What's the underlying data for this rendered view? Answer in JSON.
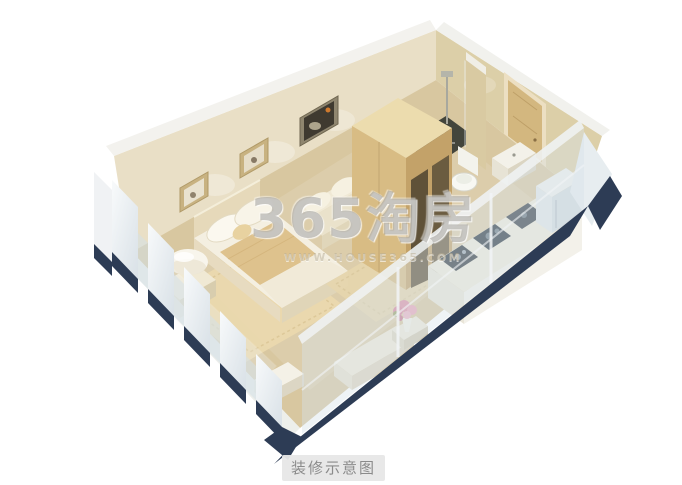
{
  "watermark": {
    "brand": "365淘房",
    "site": "WWW.HOUSE365.COM"
  },
  "caption": {
    "label": "装修示意图"
  },
  "palette": {
    "background": "#ffffff",
    "floor": "#d8c7a0",
    "wall_left": "#e9dfc6",
    "wall_right": "#dccfa8",
    "wall_cap": "#f3f2ee",
    "exterior_white": "#eef1f3",
    "base_navy": "#2d3c55",
    "glass": "#d7e2e9",
    "wardrobe_front": "#d8bc84",
    "wardrobe_side": "#c3a269",
    "wardrobe_top": "#ecdcae",
    "bed_blanket": "#dec28d",
    "rug": "#ead9ae",
    "counter_top": "#eeeadb",
    "appliance_dark": "#333c42",
    "tile_dark": "#43453c",
    "door_tan": "#d3b77f",
    "caption_bg": "#e8e8e8",
    "caption_text": "#8b8b8b",
    "watermark_gray": "#96948e"
  }
}
